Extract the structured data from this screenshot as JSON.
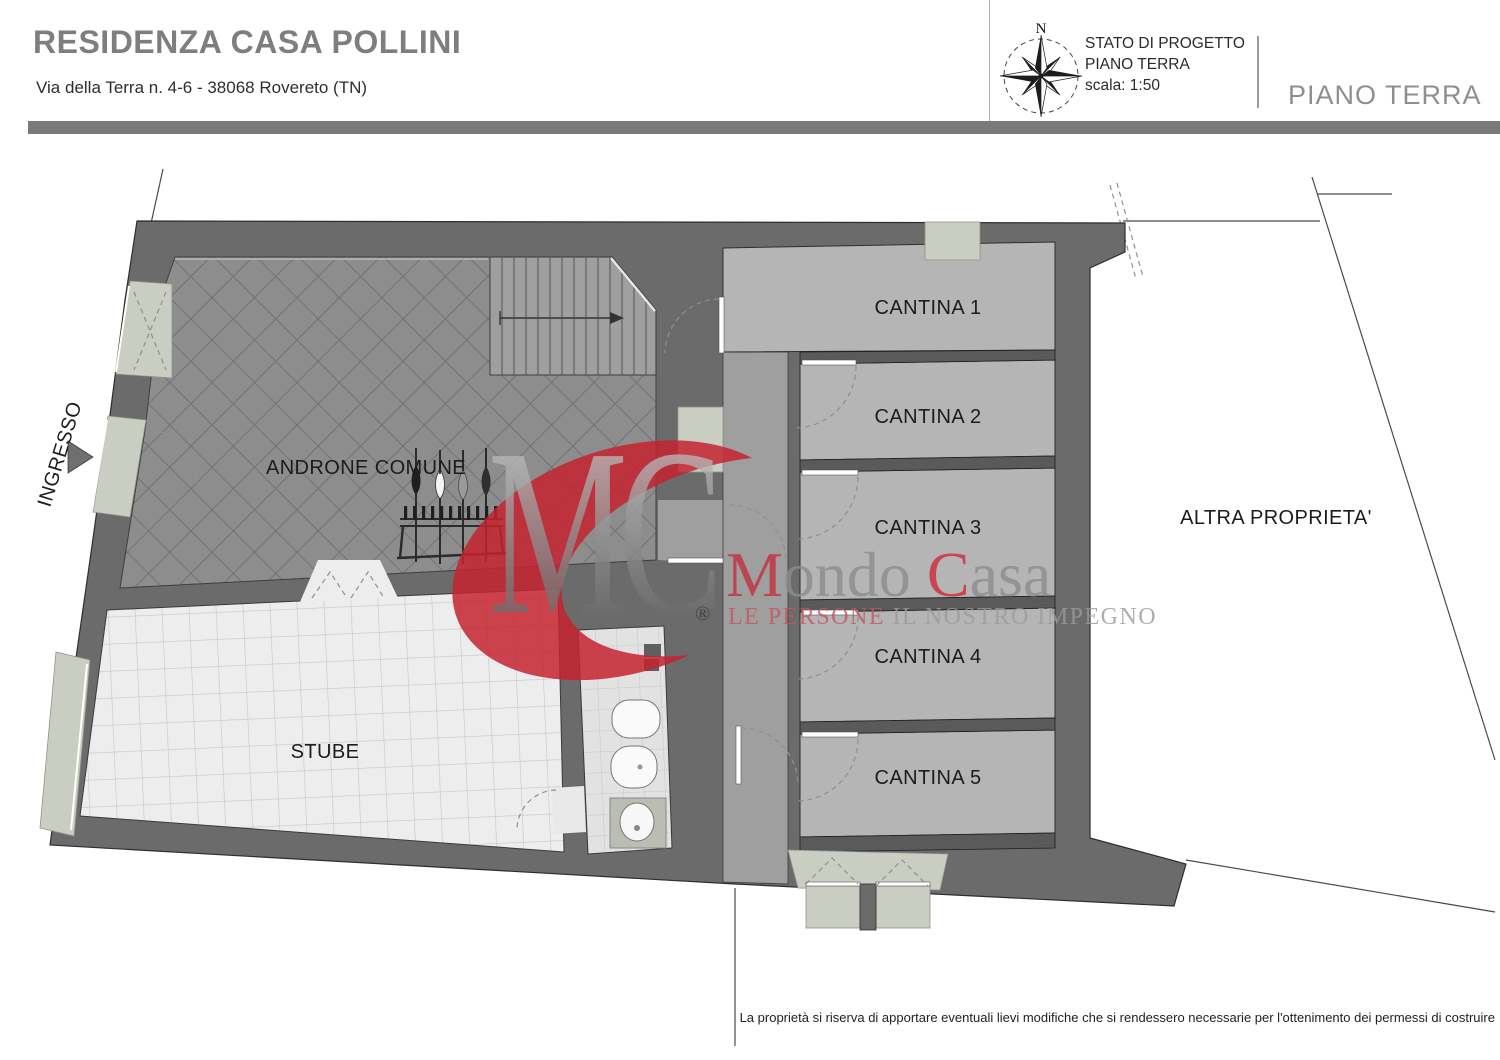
{
  "header": {
    "title": "RESIDENZA CASA POLLINI",
    "subtitle": "Via della Terra n. 4-6 - 38068 Rovereto (TN)",
    "compass_north": "N",
    "status": {
      "line1": "STATO DI PROGETTO",
      "line2": "PIANO TERRA",
      "line3": "scala: 1:50"
    },
    "floor_label": "PIANO TERRA"
  },
  "plan": {
    "labels": {
      "ingresso": "INGRESSO",
      "androne": "ANDRONE COMUNE",
      "stube": "STUBE",
      "altra_proprieta": "ALTRA PROPRIETA'"
    },
    "cantine": [
      "CANTINA 1",
      "CANTINA 2",
      "CANTINA 3",
      "CANTINA 4",
      "CANTINA 5"
    ]
  },
  "watermark": {
    "monogram": "MC",
    "registered": "®",
    "brand": {
      "initial1": "M",
      "rest1": "ondo ",
      "initial2": "C",
      "rest2": "asa"
    },
    "tagline": {
      "red": "LE PERSONE ",
      "gray": "IL NOSTRO IMPEGNO"
    }
  },
  "footer": {
    "disclaimer": "La proprietà si riserva di apportare eventuali lievi modifiche che si rendessero necessarie per l'ottenimento dei permessi di costruire"
  },
  "colors": {
    "wall": "#6b6b6b",
    "cantina_floor": "#b5b5b5",
    "corridor_floor": "#9f9f9f",
    "stube_floor": "#ededed",
    "tile_accent": "#cacdc2",
    "brand_red": "#c42330",
    "header_gray": "#7e7e7e",
    "bar_gray": "#7a7a7a"
  }
}
